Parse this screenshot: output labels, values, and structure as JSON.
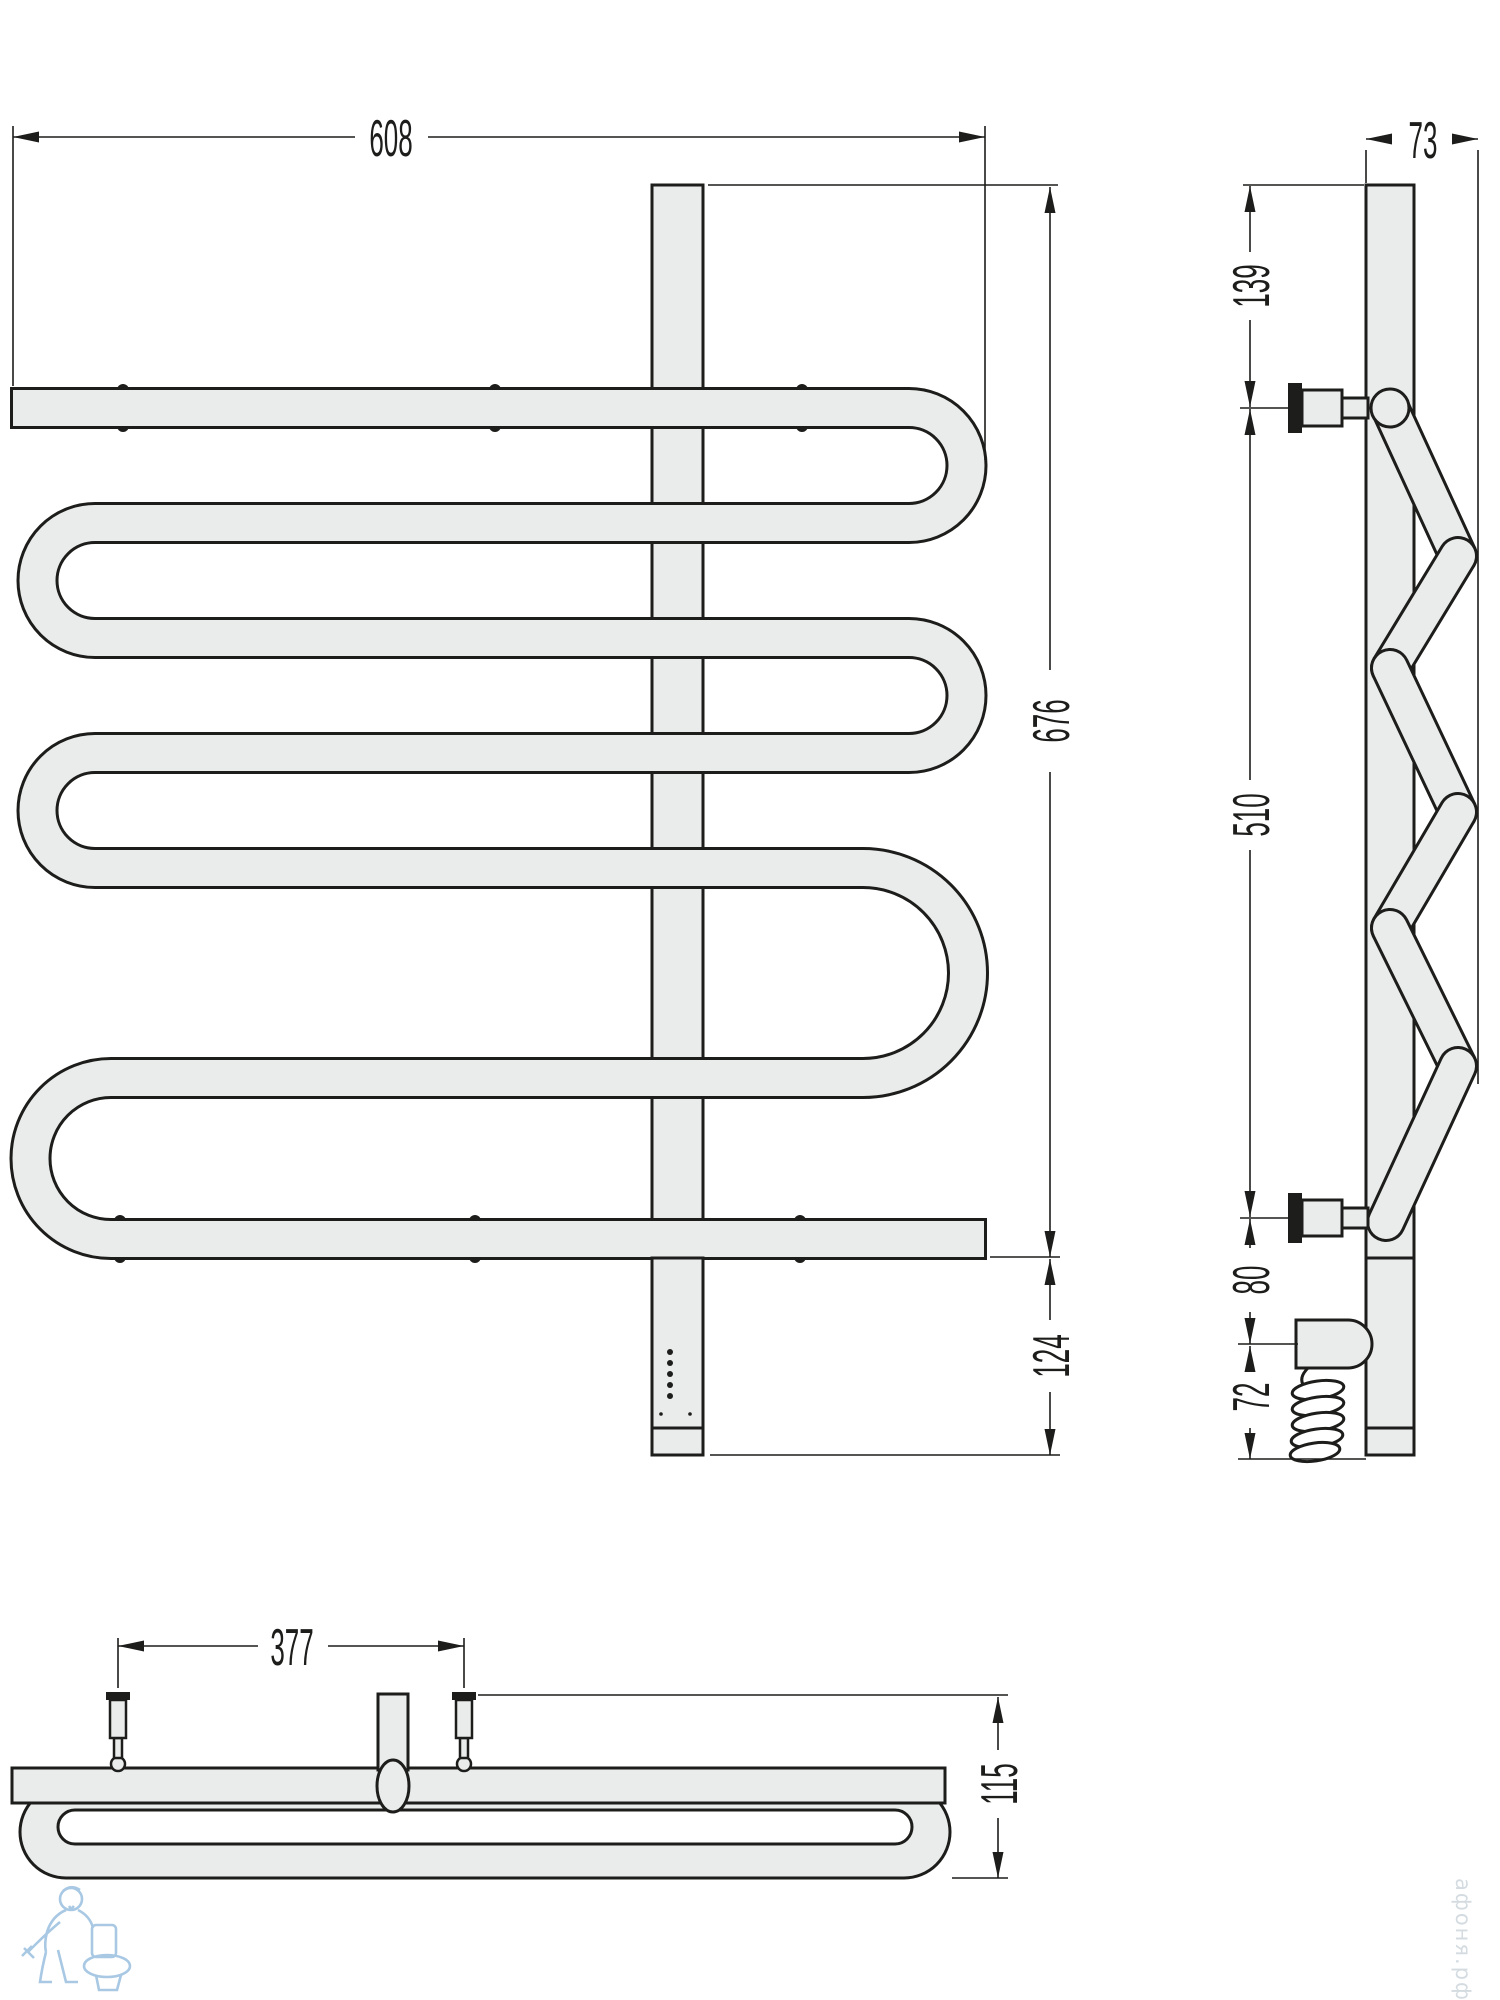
{
  "drawing": {
    "kind": "towel-rail-technical-drawing",
    "colors": {
      "line": "#1d1d1b",
      "tube_fill": "#e9eceb",
      "watermark_blue": "#9fc3e0"
    },
    "views": {
      "front": {
        "dimensions": {
          "width": "608",
          "height": "676",
          "bottom_offset": "124"
        }
      },
      "side": {
        "dimensions": {
          "depth": "73",
          "top_to_bracket": "139",
          "bracket_span": "510",
          "bracket_to_heater": "80",
          "heater_to_bottom": "72"
        }
      },
      "top": {
        "dimensions": {
          "bracket_span": "377",
          "depth": "115"
        }
      }
    },
    "watermark": {
      "site_text": "афоня.рф"
    }
  }
}
